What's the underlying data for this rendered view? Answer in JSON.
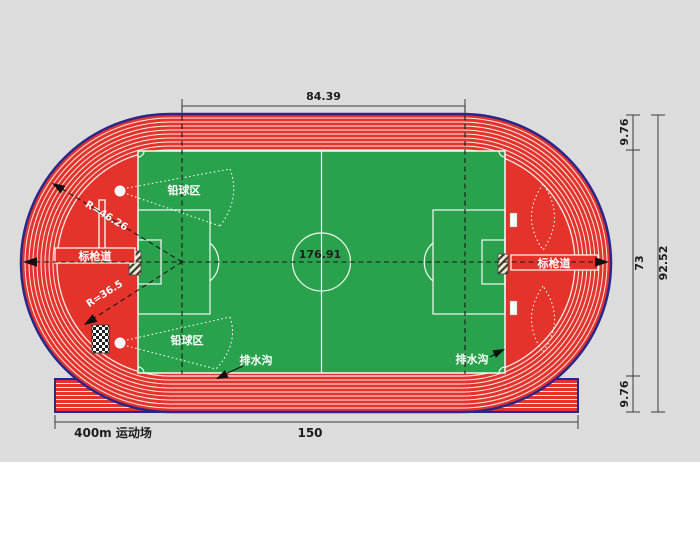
{
  "diagram": {
    "title": "400m 运动场",
    "colors": {
      "track_red": "#e5332b",
      "border_navy": "#28288c",
      "field_green": "#2aa24d",
      "lane_line": "#f7eeec",
      "background": "#dcdcdc"
    },
    "dimensions": {
      "top_straight": "84.39",
      "track_width_top": "9.76",
      "infield_width": "73",
      "overall_width": "92.52",
      "track_width_bottom": "9.76",
      "bottom_length": "150",
      "overall_length": "176.91",
      "radius_outer": "R=46.26",
      "radius_inner": "R=36.5"
    },
    "labels": {
      "site_name": "400m 运动场",
      "javelin_lane_left": "标枪道",
      "javelin_lane_right": "标枪道",
      "shot_put_top": "铅球区",
      "shot_put_bottom": "铅球区",
      "drain_left": "排水沟",
      "drain_right": "排水沟"
    }
  }
}
